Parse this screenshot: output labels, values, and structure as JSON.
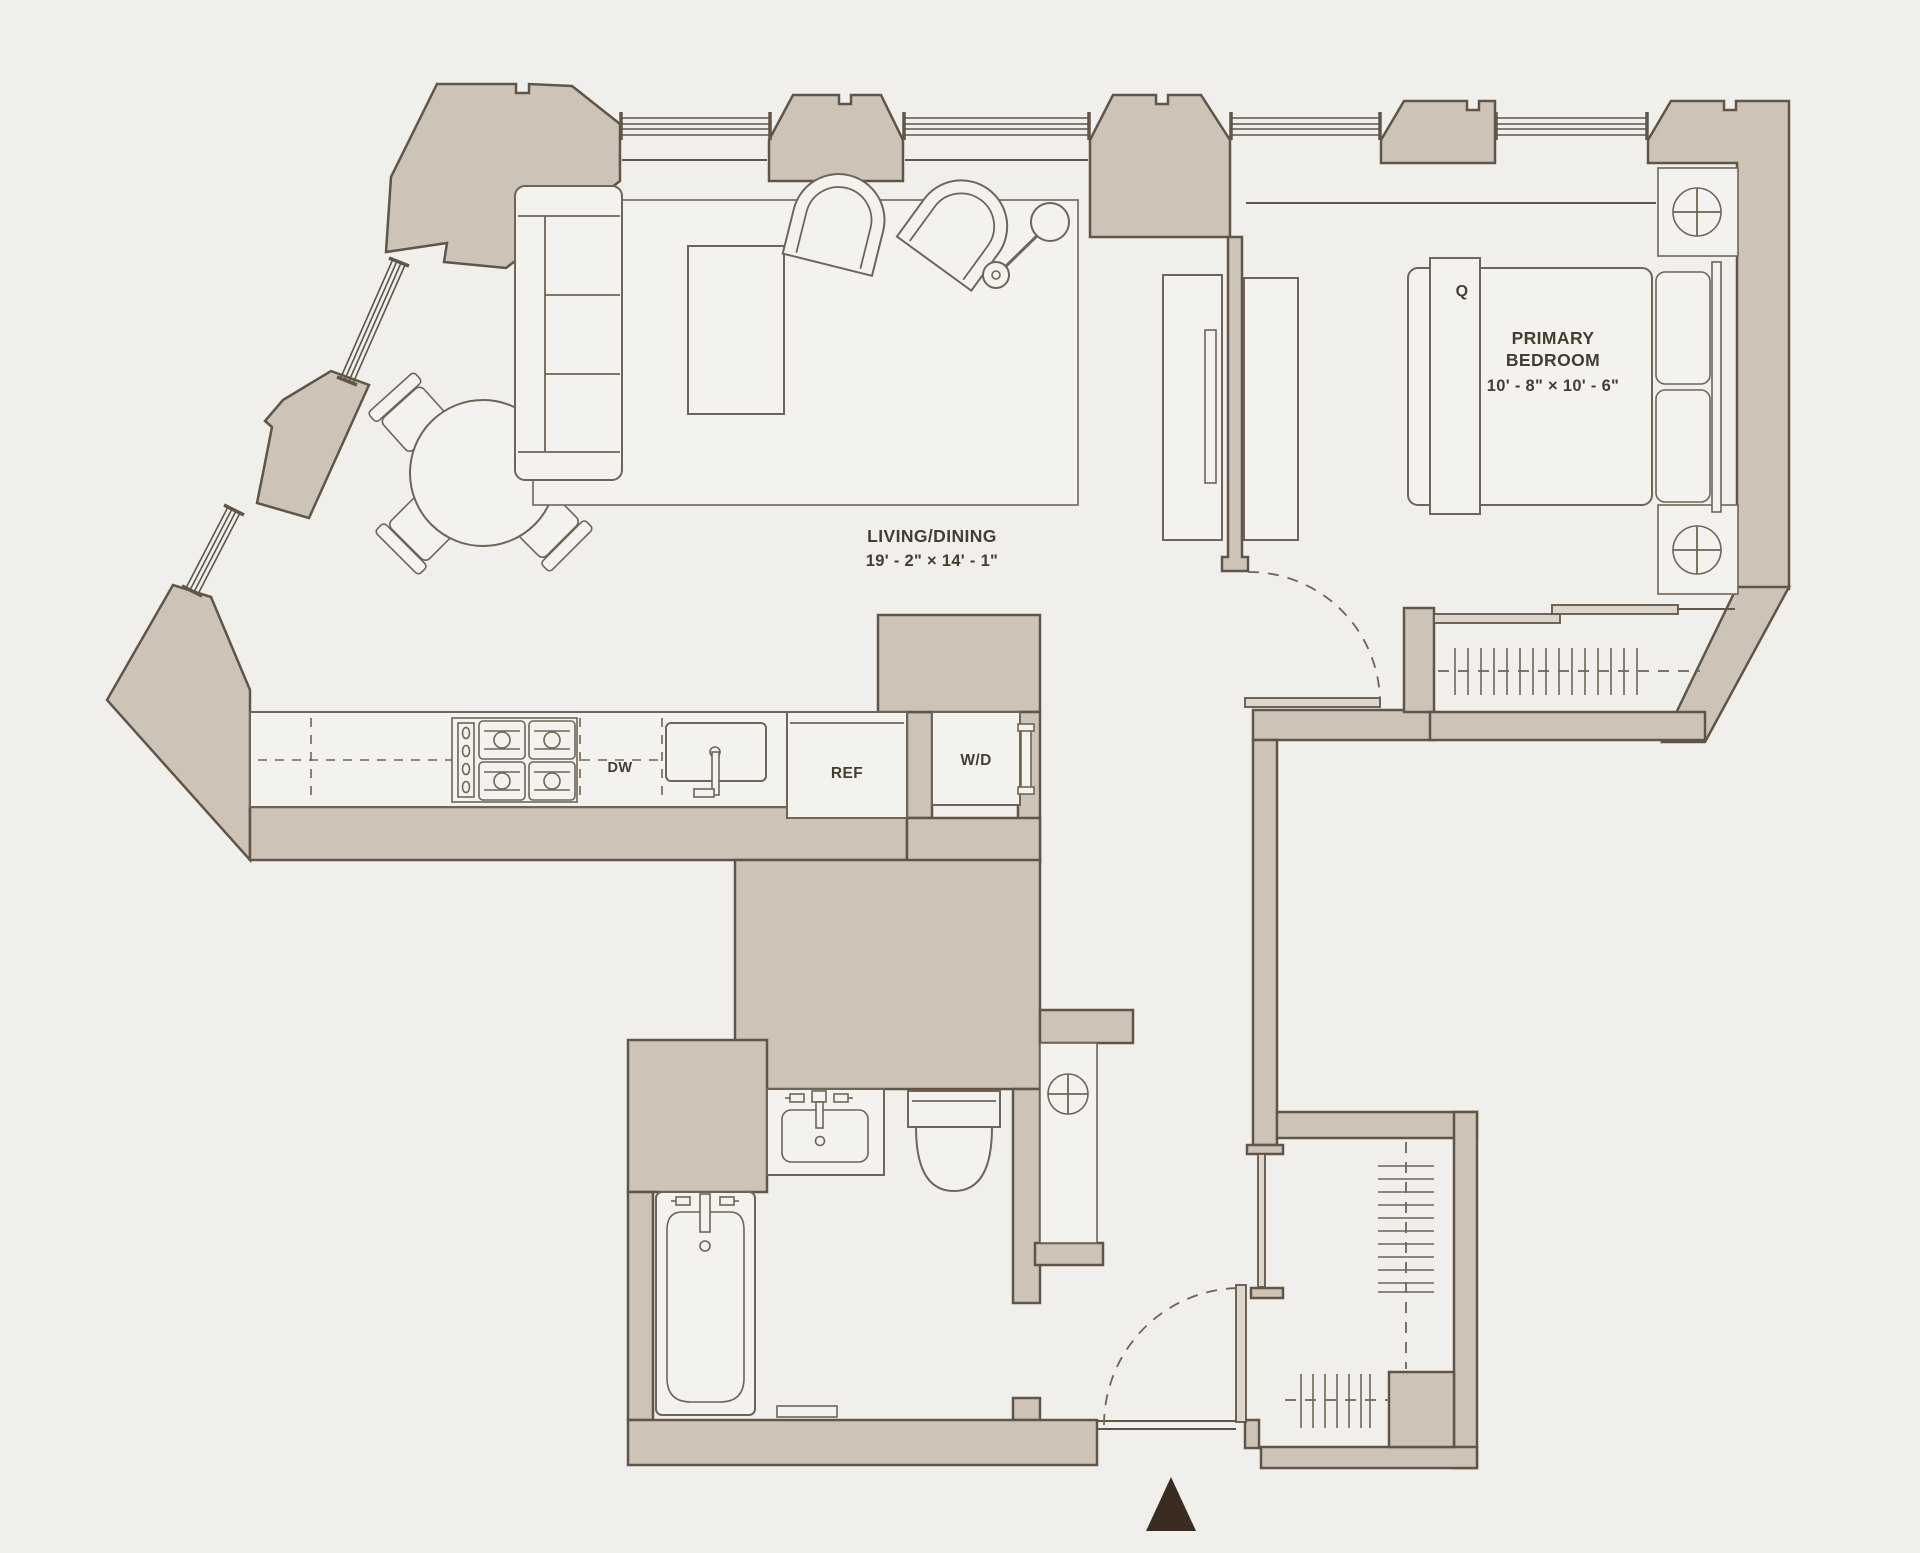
{
  "plan": {
    "type": "apartment-floor-plan",
    "rooms": {
      "living_dining": {
        "name": "LIVING/DINING",
        "dims": "19' - 2\" × 14' - 1\""
      },
      "primary_bedroom": {
        "name_line1": "PRIMARY",
        "name_line2": "BEDROOM",
        "dims": "10' - 8\" × 10' - 6\""
      }
    },
    "labels": {
      "bed_size": "Q",
      "dishwasher": "DW",
      "refrigerator": "REF",
      "washer_dryer": "W/D"
    },
    "colors": {
      "background": "#f1efec",
      "wall_fill": "#cdc4b7",
      "wall_stroke": "#5f5548",
      "furniture_stroke": "#6e6457",
      "text": "#463d31",
      "north_arrow": "#3a2c20"
    }
  }
}
